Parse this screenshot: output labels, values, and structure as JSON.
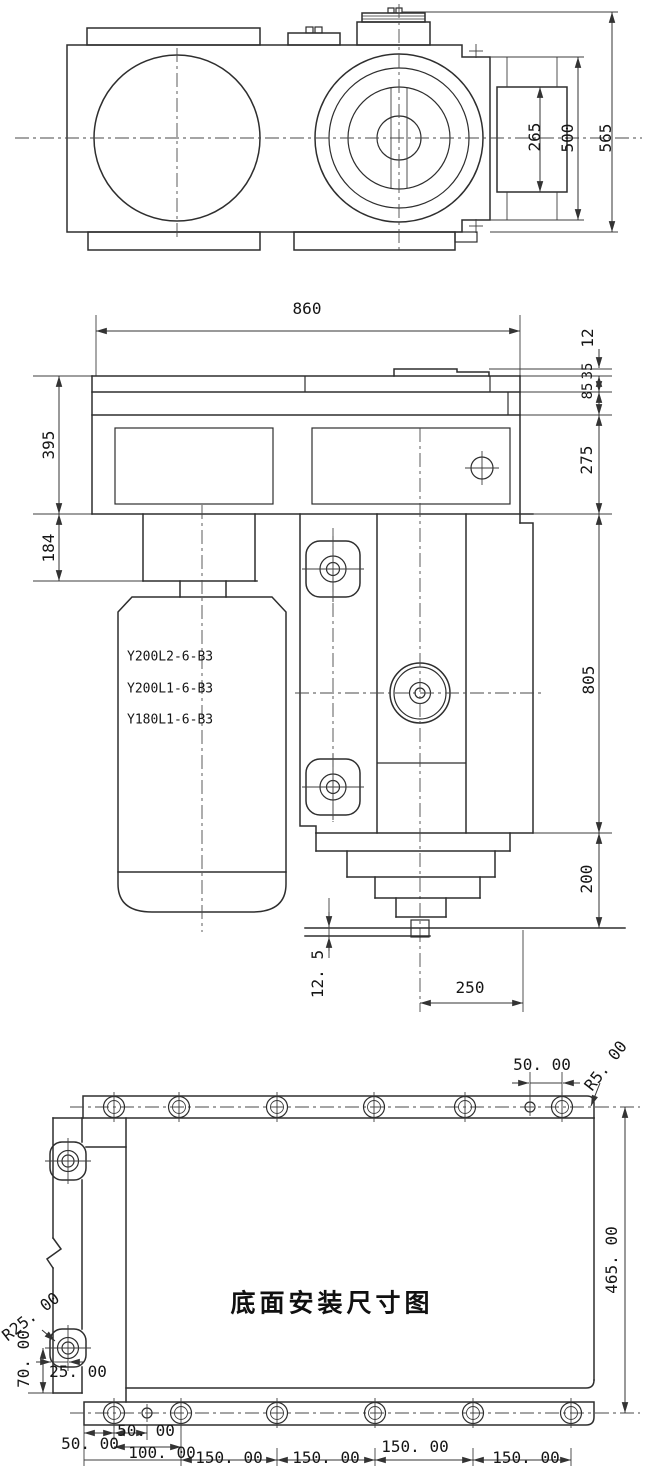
{
  "drawing": {
    "line_color": "#2e2e2e",
    "background": "#ffffff",
    "top_view": {
      "dims": {
        "bore_span": "265",
        "flange_span": "500",
        "overall_width": "565"
      }
    },
    "front_view": {
      "dims": {
        "length": "860",
        "top_plate": "12",
        "step_a": "35",
        "step_b": "85",
        "upper_height": "275",
        "body_height": "805",
        "base_height": "200",
        "left_upper_height": "395",
        "motor_flange_height": "184",
        "foot_offset": "12. 5",
        "output_offset": "250"
      },
      "motor_models": [
        "Y200L2-6-B3",
        "Y200L1-6-B3",
        "Y180L1-6-B3"
      ]
    },
    "bottom_view": {
      "title": "底面安装尺寸图",
      "dims": {
        "hole_pitch_top": "50. 00",
        "corner_radius": "R5. 00",
        "depth": "465. 00",
        "tab_radius": "R25. 00",
        "tab_height": "70. 00",
        "tab_hole_offset": "25. 00",
        "edge_to_hole": "50. 00",
        "hole_pitch_small": "50. 00",
        "pitch_100": "100. 00",
        "pitch_150_a": "150. 00",
        "pitch_150_b": "150. 00",
        "pitch_150_c": "150. 00",
        "pitch_150_d": "150. 00"
      }
    }
  }
}
